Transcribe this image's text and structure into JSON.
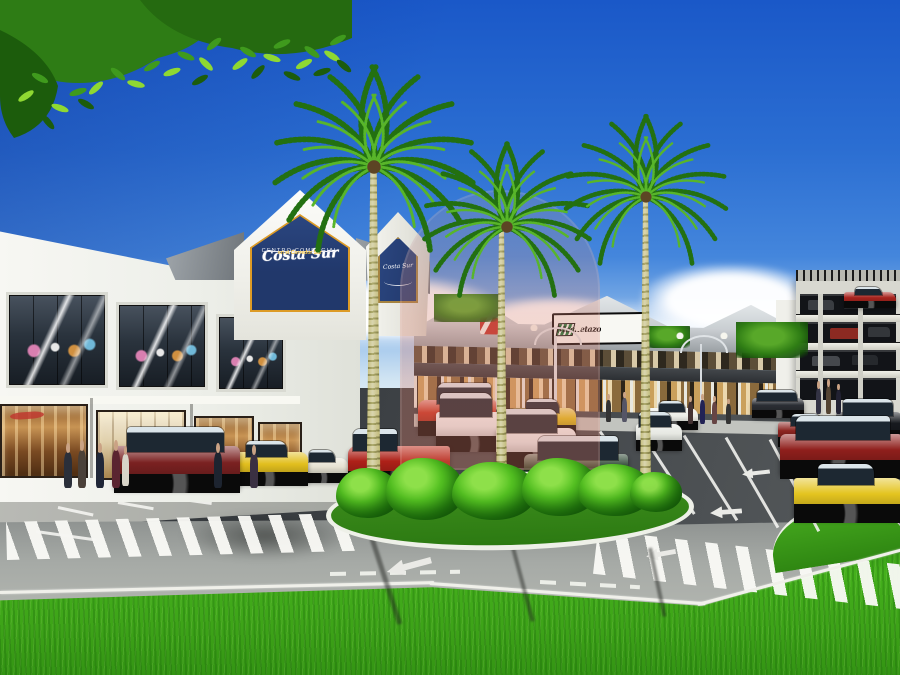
{
  "meta": {
    "title": "Centro Comercial Costa Sur - exterior architectural rendering"
  },
  "signage": {
    "main_sign": {
      "script_name": "Costa Sur",
      "line1": "CENTRO COMERCIAL",
      "line2": "en el Corredor Sur"
    },
    "side_sign": {
      "script_name": "Costa Sur"
    },
    "tenant_logo": {
      "prefix": "el",
      "name": "Machetazo"
    }
  },
  "colors": {
    "skytop": "#1a58c8",
    "skyhz": "#cfe3f2",
    "navy": "#21386b",
    "signborder": "#dd9b26",
    "trunk": "#c9c392",
    "palmleaf": "#237011",
    "palmleaf2": "#58b52a",
    "bushhi": "#8ee04a"
  },
  "sprites": [
    {
      "cls": "cloud",
      "name": "cloud",
      "x": 300,
      "y": 276,
      "w": 200,
      "h": 60
    },
    {
      "cls": "cloud",
      "name": "cloud",
      "x": 140,
      "y": 298,
      "w": 150,
      "h": 44
    },
    {
      "cls": "cloud",
      "name": "cloud",
      "x": 470,
      "y": 296,
      "w": 170,
      "h": 48
    },
    {
      "cls": "cloud",
      "name": "cloud",
      "x": 640,
      "y": 264,
      "w": 180,
      "h": 66
    },
    {
      "cls": "cloud",
      "name": "cloud",
      "x": 770,
      "y": 286,
      "w": 150,
      "h": 54
    },
    {
      "cls": "cloud",
      "name": "cloud",
      "x": 852,
      "y": 300,
      "w": 90,
      "h": 40
    },
    {
      "cls": "treeblob",
      "name": "background-tree",
      "x": 434,
      "y": 294,
      "w": 66,
      "h": 28
    },
    {
      "cls": "treeblob",
      "name": "background-tree",
      "x": 736,
      "y": 322,
      "w": 72,
      "h": 36
    },
    {
      "cls": "treeblob",
      "name": "background-tree",
      "x": 648,
      "y": 326,
      "w": 42,
      "h": 22
    },
    {
      "cls": "sshadow",
      "name": "road-shadow",
      "x": 180,
      "y": 512,
      "w": 170,
      "h": 48,
      "z": 21
    },
    {
      "cls": "xwalk",
      "name": "crosswalk-left",
      "x": 6,
      "y": 522,
      "w": 356,
      "h": 38,
      "r": -1.5,
      "z": 22
    },
    {
      "cls": "xwalk",
      "name": "crosswalk-right",
      "x": 598,
      "y": 530,
      "w": 310,
      "h": 44,
      "r": 6.5,
      "z": 22
    },
    {
      "cls": "eline",
      "name": "road-edge-line",
      "x": 0,
      "y": 591,
      "w": 434,
      "h": 3,
      "r": -1.3,
      "z": 23
    },
    {
      "cls": "eline",
      "name": "road-edge-line",
      "x": 430,
      "y": 582,
      "w": 276,
      "h": 3,
      "r": 4.2,
      "z": 23
    },
    {
      "cls": "eline",
      "name": "road-edge-line",
      "x": 698,
      "y": 603,
      "w": 212,
      "h": 3,
      "r": -15,
      "z": 23
    },
    {
      "cls": "dashline",
      "name": "lane-dashes",
      "x": 330,
      "y": 572,
      "w": 130,
      "h": 4,
      "r": -1,
      "z": 23
    },
    {
      "cls": "dashline",
      "name": "lane-dashes",
      "x": 540,
      "y": 580,
      "w": 100,
      "h": 4,
      "r": 3,
      "z": 23
    },
    {
      "cls": "pline",
      "name": "parking-line",
      "x": 600,
      "y": 430,
      "w": 92,
      "h": 3,
      "r": 55,
      "z": 24
    },
    {
      "cls": "pline",
      "name": "parking-line",
      "x": 642,
      "y": 432,
      "w": 96,
      "h": 3,
      "r": 57,
      "z": 24
    },
    {
      "cls": "pline",
      "name": "parking-line",
      "x": 684,
      "y": 434,
      "w": 100,
      "h": 3,
      "r": 58,
      "z": 24
    },
    {
      "cls": "pline",
      "name": "parking-line",
      "x": 726,
      "y": 436,
      "w": 104,
      "h": 3,
      "r": 60,
      "z": 24
    },
    {
      "cls": "pline",
      "name": "parking-line",
      "x": 770,
      "y": 438,
      "w": 104,
      "h": 3,
      "r": 62,
      "z": 24
    },
    {
      "cls": "pline",
      "name": "parking-line",
      "x": 58,
      "y": 506,
      "w": 36,
      "h": 3,
      "r": 12,
      "z": 24
    },
    {
      "cls": "pline",
      "name": "parking-line",
      "x": 118,
      "y": 501,
      "w": 36,
      "h": 3,
      "r": 10,
      "z": 24
    },
    {
      "cls": "pline",
      "name": "parking-line",
      "x": 176,
      "y": 497,
      "w": 36,
      "h": 3,
      "r": 8,
      "z": 24
    },
    {
      "cls": "pline",
      "name": "parking-line",
      "x": 36,
      "y": 530,
      "w": 60,
      "h": 3,
      "r": 8,
      "z": 24
    },
    {
      "cls": "arrow-l",
      "name": "pavement-arrow",
      "x": 742,
      "y": 468,
      "w": 28,
      "h": 10,
      "r": -6,
      "z": 24
    },
    {
      "cls": "arrow-l",
      "name": "pavement-arrow",
      "x": 710,
      "y": 506,
      "w": 32,
      "h": 12,
      "r": -4,
      "z": 24
    },
    {
      "cls": "arrow-l",
      "name": "pavement-arrow",
      "x": 646,
      "y": 548,
      "w": 30,
      "h": 12,
      "r": -10,
      "z": 24
    },
    {
      "cls": "arrow-l",
      "name": "lane-arrow",
      "x": 386,
      "y": 558,
      "w": 46,
      "h": 16,
      "r": -15,
      "z": 24
    },
    {
      "cls": "shadowline",
      "name": "palm-shadow",
      "x": 372,
      "y": 536,
      "w": 90,
      "h": 5,
      "r": 72,
      "z": 24
    },
    {
      "cls": "shadowline",
      "name": "palm-shadow",
      "x": 512,
      "y": 542,
      "w": 80,
      "h": 4,
      "r": 75,
      "z": 24
    },
    {
      "cls": "shadowline",
      "name": "palm-shadow",
      "x": 650,
      "y": 546,
      "w": 70,
      "h": 4,
      "r": 78,
      "z": 24
    },
    {
      "cls": "lamp",
      "name": "street-lamp",
      "x": 554,
      "y": 336,
      "w": 3,
      "h": 88,
      "c": "#e0e4e6"
    },
    {
      "cls": "lamp",
      "name": "street-lamp",
      "x": 700,
      "y": 344,
      "w": 2,
      "h": 76,
      "c": "#d8dce0"
    },
    {
      "cls": "car-sedan",
      "name": "car-red-rooftop",
      "x": 844,
      "y": 292,
      "w": 52,
      "h": 14,
      "c": "#a8241e",
      "z": 30
    },
    {
      "cls": "car-sedan",
      "name": "car-white-sedan-lot",
      "x": 648,
      "y": 408,
      "w": 50,
      "h": 20,
      "c": "#ecede7",
      "z": 40
    },
    {
      "cls": "car-van",
      "name": "car-white-van-lot",
      "x": 636,
      "y": 424,
      "w": 46,
      "h": 24,
      "c": "#e6e8e2",
      "z": 40
    },
    {
      "cls": "car-suv",
      "name": "car-dark-suv-lot",
      "x": 752,
      "y": 398,
      "w": 52,
      "h": 18,
      "c": "#2b2e34",
      "z": 40
    },
    {
      "cls": "car-sedan",
      "name": "car-red-wagon-lot",
      "x": 778,
      "y": 422,
      "w": 60,
      "h": 22,
      "c": "#8c2420",
      "z": 41
    },
    {
      "cls": "car-suv",
      "name": "car-black-suv-lot",
      "x": 836,
      "y": 412,
      "w": 66,
      "h": 28,
      "c": "#171a1f",
      "z": 41
    },
    {
      "cls": "car-van",
      "name": "car-red-minivan",
      "x": 418,
      "y": 400,
      "w": 78,
      "h": 32,
      "c": "#c23020",
      "flip": true,
      "z": 42
    },
    {
      "cls": "car-van",
      "name": "car-white-van",
      "x": 436,
      "y": 412,
      "w": 74,
      "h": 36,
      "c": "#eaedee",
      "z": 42
    },
    {
      "cls": "car-sedan",
      "name": "car-yellow-taxi-mid",
      "x": 512,
      "y": 408,
      "w": 64,
      "h": 26,
      "c": "#e0c11d",
      "z": 42
    },
    {
      "cls": "car-van",
      "name": "car-white-minivan",
      "x": 496,
      "y": 428,
      "w": 80,
      "h": 36,
      "c": "#e4e7e8",
      "z": 43
    },
    {
      "cls": "car-suv",
      "name": "car-dark-green-suv",
      "x": 524,
      "y": 454,
      "w": 104,
      "h": 40,
      "c": "#16321c",
      "flip": true,
      "z": 44
    },
    {
      "cls": "car-pickup",
      "name": "car-red-pickup",
      "x": 348,
      "y": 446,
      "w": 102,
      "h": 38,
      "c": "#ae2018",
      "flip": true,
      "z": 43
    },
    {
      "cls": "car-suv",
      "name": "car-maroon-suv",
      "x": 114,
      "y": 446,
      "w": 126,
      "h": 42,
      "c": "#7a2121",
      "z": 44
    },
    {
      "cls": "car-sedan",
      "name": "car-yellow-taxi-left",
      "x": 228,
      "y": 452,
      "w": 80,
      "h": 30,
      "c": "#e2bf1e",
      "z": 43
    },
    {
      "cls": "car-sedan",
      "name": "car-cream-sedan",
      "x": 298,
      "y": 458,
      "w": 50,
      "h": 22,
      "c": "#e6e2d2",
      "z": 42
    },
    {
      "cls": "car-suv",
      "name": "car-red-suv-right",
      "x": 780,
      "y": 434,
      "w": 122,
      "h": 40,
      "c": "#8f1f1c",
      "flip": true,
      "z": 43
    },
    {
      "cls": "car-sedan",
      "name": "car-yellow-taxi-right",
      "x": 794,
      "y": 478,
      "w": 108,
      "h": 40,
      "c": "#e4c41f",
      "z": 44
    },
    {
      "cls": "person",
      "name": "pedestrian",
      "x": 64,
      "y": 452,
      "w": 8,
      "h": 36,
      "c": "#2a2f3a"
    },
    {
      "cls": "person",
      "name": "pedestrian",
      "x": 78,
      "y": 450,
      "w": 8,
      "h": 38,
      "c": "#4a4038"
    },
    {
      "cls": "person",
      "name": "pedestrian",
      "x": 96,
      "y": 452,
      "w": 8,
      "h": 36,
      "c": "#202738"
    },
    {
      "cls": "person",
      "name": "pedestrian",
      "x": 112,
      "y": 450,
      "w": 8,
      "h": 38,
      "c": "#5a2430"
    },
    {
      "cls": "person",
      "name": "pedestrian",
      "x": 122,
      "y": 454,
      "w": 7,
      "h": 32,
      "c": "#d8d4c8"
    },
    {
      "cls": "person",
      "name": "pedestrian",
      "x": 214,
      "y": 452,
      "w": 8,
      "h": 36,
      "c": "#1d2430"
    },
    {
      "cls": "person",
      "name": "pedestrian",
      "x": 250,
      "y": 454,
      "w": 8,
      "h": 34,
      "c": "#3a3042"
    },
    {
      "cls": "person",
      "name": "pedestrian",
      "x": 606,
      "y": 400,
      "w": 5,
      "h": 22,
      "c": "#333333"
    },
    {
      "cls": "person",
      "name": "pedestrian",
      "x": 622,
      "y": 398,
      "w": 5,
      "h": 24,
      "c": "#555566"
    },
    {
      "cls": "person",
      "name": "pedestrian",
      "x": 688,
      "y": 402,
      "w": 5,
      "h": 22,
      "c": "#443333"
    },
    {
      "cls": "person",
      "name": "pedestrian",
      "x": 700,
      "y": 400,
      "w": 5,
      "h": 24,
      "c": "#222255"
    },
    {
      "cls": "person",
      "name": "pedestrian",
      "x": 712,
      "y": 402,
      "w": 5,
      "h": 22,
      "c": "#664444"
    },
    {
      "cls": "person",
      "name": "pedestrian",
      "x": 726,
      "y": 404,
      "w": 5,
      "h": 20,
      "c": "#333333"
    },
    {
      "cls": "person",
      "name": "pedestrian",
      "x": 816,
      "y": 388,
      "w": 5,
      "h": 26,
      "c": "#333344"
    },
    {
      "cls": "person",
      "name": "pedestrian",
      "x": 826,
      "y": 386,
      "w": 5,
      "h": 28,
      "c": "#544433"
    },
    {
      "cls": "person",
      "name": "pedestrian",
      "x": 836,
      "y": 390,
      "w": 5,
      "h": 24,
      "c": "#222233"
    },
    {
      "cls": "bush",
      "name": "island-bush",
      "x": 336,
      "y": 468,
      "w": 64,
      "h": 50
    },
    {
      "cls": "bush",
      "name": "island-bush",
      "x": 386,
      "y": 458,
      "w": 78,
      "h": 62
    },
    {
      "cls": "bush",
      "name": "island-bush",
      "x": 452,
      "y": 462,
      "w": 84,
      "h": 58
    },
    {
      "cls": "bush",
      "name": "island-bush",
      "x": 522,
      "y": 458,
      "w": 76,
      "h": 58
    },
    {
      "cls": "bush",
      "name": "island-bush",
      "x": 578,
      "y": 464,
      "w": 74,
      "h": 52
    },
    {
      "cls": "bush",
      "name": "island-bush",
      "x": 630,
      "y": 472,
      "w": 52,
      "h": 40
    }
  ]
}
